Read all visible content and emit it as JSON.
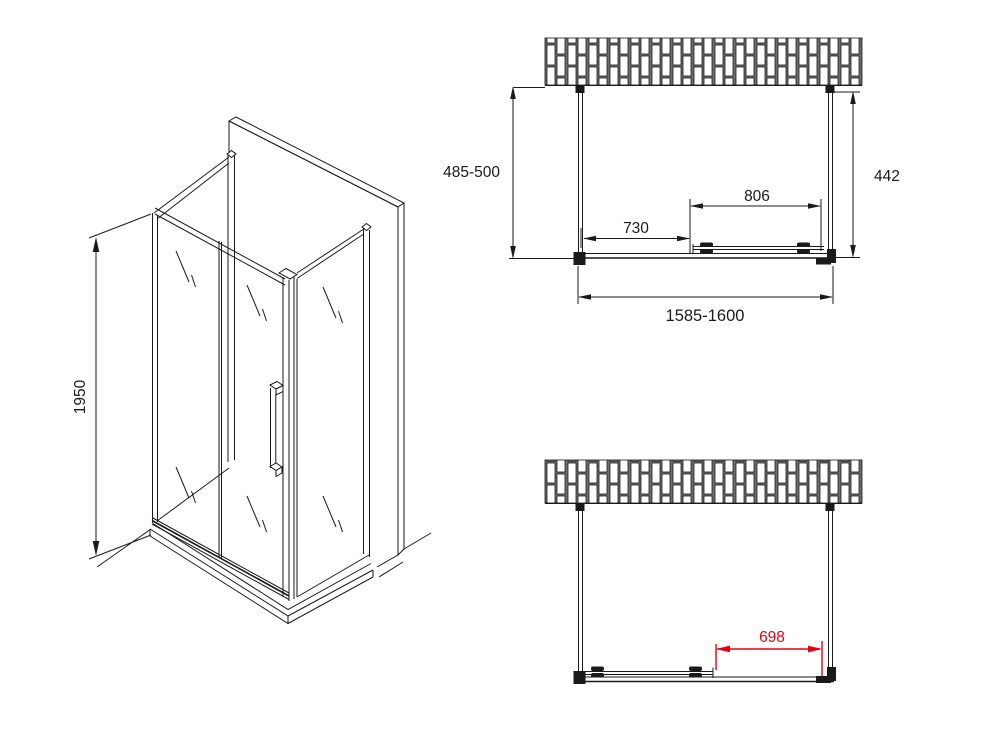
{
  "drawing": {
    "type": "shower-enclosure-technical-drawing",
    "colors": {
      "line": "#1a1a1a",
      "dimension_red": "#e60012",
      "background": "#ffffff"
    },
    "isometric_view": {
      "height": "1950"
    },
    "top_plan_view": {
      "depth_range": "485-500",
      "panel_depth": "442",
      "fixed_panel_width": "730",
      "door_width": "806",
      "total_width_range": "1585-1600"
    },
    "front_plan_view": {
      "door_opening": "698"
    }
  }
}
